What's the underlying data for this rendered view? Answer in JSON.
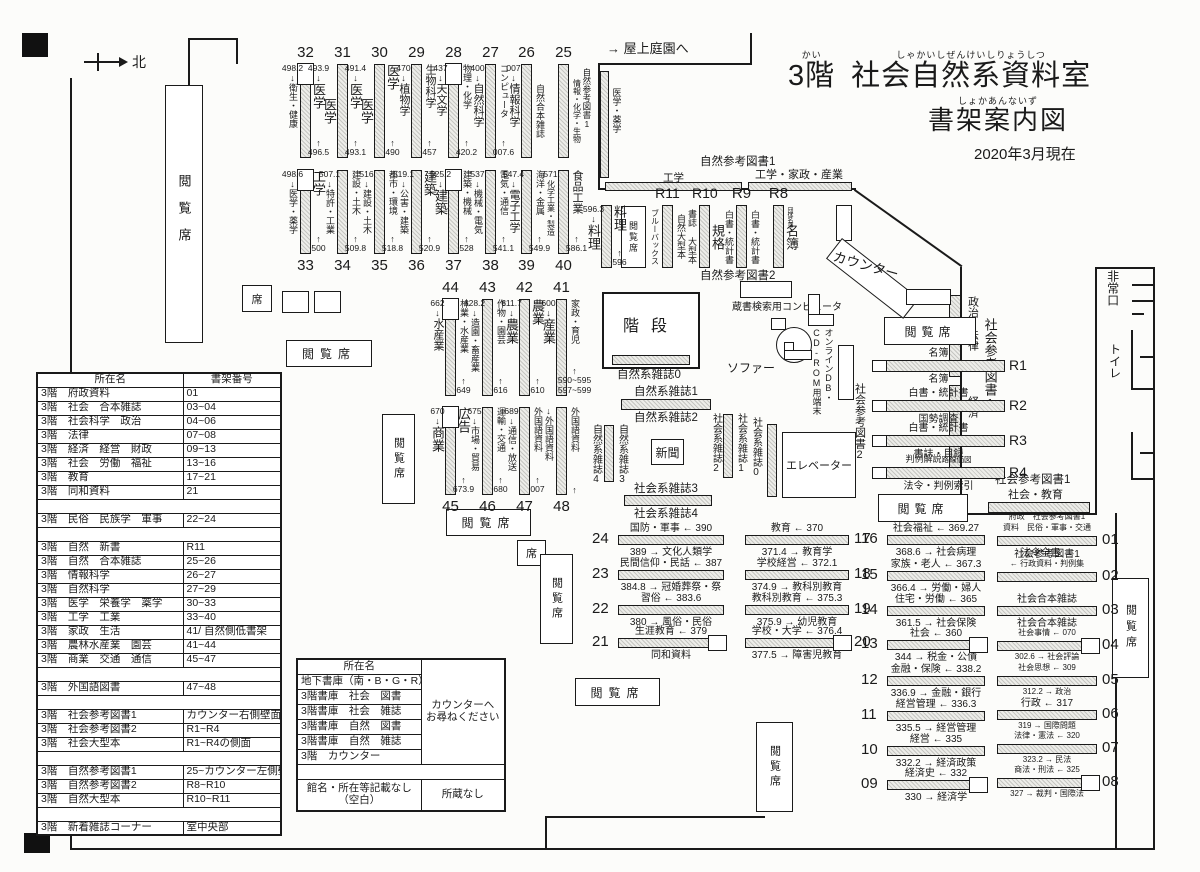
{
  "title": {
    "floor": "3階",
    "floor_ruby": "かい",
    "name": "社会自然系資料室",
    "name_ruby": "しゃかいしぜんけいしりょうしつ",
    "sub": "書架案内図",
    "sub_ruby": "しょかあんないず",
    "date": "2020年3月現在"
  },
  "misc": {
    "roof_garden": "→ 屋上庭園へ",
    "compass": "北",
    "reading_seat": "閲覧席",
    "seat": "席",
    "stairs": "階段",
    "newspaper": "新聞",
    "sofa": "ソファー",
    "elevator": "エレベーター",
    "counter": "カウンター",
    "opac": "蔵書検索用コンピュータ",
    "online1": "オンラインDB・",
    "online2": "CD-ROM用端末",
    "emergency_exit": "非常口",
    "toilet": "トイレ"
  },
  "wall": {
    "nat_ref1_v": "自然参考図書1",
    "med_pharm": "医学・薬学",
    "nat_ref1_h": "自然参考図書1",
    "eng": "工学",
    "eng_home_ind": "工学・家政・産業",
    "nat_ref2": "自然参考図書2",
    "politics_law": "政治・法律",
    "economy": "経済",
    "soc_ref1_big": "社会参考図書1",
    "soc_ref1": "社会参考図書1",
    "soc_edu": "社会・教育"
  },
  "mag": {
    "n0": "自然系雑誌0",
    "n1": "自然系雑誌1",
    "n2": "自然系雑誌2",
    "n3": "自然系雑誌3",
    "n4": "自然系雑誌4",
    "s0": "社会系雑誌0",
    "s1": "社会系雑誌1",
    "s2": "社会系雑誌2",
    "s3": "社会系雑誌3",
    "s4": "社会系雑誌4"
  },
  "shelf_rows": {
    "row1": {
      "units": [
        {
          "num": "32",
          "panel": true,
          "left": {
            "n1": "498.2",
            "a1": "↓",
            "name": "衛生・健康"
          },
          "right": {
            "n1": "493.9",
            "a1": "↓",
            "name": "医学",
            "a2": "↑",
            "n2": "496.5"
          }
        },
        {
          "num": "31",
          "left": {
            "name": "医学"
          },
          "right": {
            "n1": "491.4",
            "a1": "↓",
            "name": "医学",
            "a2": "↑",
            "n2": "493.1"
          }
        },
        {
          "num": "30",
          "left": {
            "name": "医学"
          },
          "right": {
            "name": "医学",
            "a2": "↑",
            "n2": "490"
          }
        },
        {
          "num": "29",
          "left": {
            "n1": "470",
            "a1": "↓",
            "name": "植物学"
          },
          "right": {
            "name": "生物科学",
            "a2": "↑",
            "n2": "457"
          }
        },
        {
          "num": "28",
          "panel": true,
          "left": {
            "n1": "437",
            "a1": "↓",
            "name": "天文学"
          },
          "right": {
            "name": "物理・化学",
            "a2": "↑",
            "n2": "420.2"
          }
        },
        {
          "num": "27",
          "left": {
            "n1": "400",
            "a1": "↓",
            "name": "自然科学"
          },
          "right": {
            "name": "コンピュータ",
            "a2": "↑",
            "n2": "007.6"
          }
        },
        {
          "num": "26",
          "left": {
            "n1": "007",
            "a1": "↓",
            "name": "情報科学"
          },
          "right": {
            "name": "自然合本雑誌"
          }
        },
        {
          "num": "25",
          "right": {
            "name": "情報・化学・生物"
          }
        }
      ]
    },
    "row2": {
      "units": [
        {
          "num": "33",
          "panel": true,
          "left": {
            "n1": "498.6",
            "a1": "↓",
            "name": "医学・薬学"
          },
          "right": {
            "name": "工学",
            "a2": "↑",
            "n2": "500"
          }
        },
        {
          "num": "34",
          "left": {
            "n1": "507.1",
            "a1": "↓",
            "name": "特許・工業"
          },
          "right": {
            "name": "建設・土木",
            "a2": "↑",
            "n2": "509.8"
          }
        },
        {
          "num": "35",
          "left": {
            "n1": "516",
            "a1": "↓",
            "name": "建設・土木"
          },
          "right": {
            "name": "都市・環境",
            "a2": "↑",
            "n2": "518.8"
          }
        },
        {
          "num": "36",
          "left": {
            "n1": "519.1",
            "a1": "↓",
            "name": "公害・建築"
          },
          "right": {
            "name": "建築",
            "a2": "↑",
            "n2": "520.9"
          }
        },
        {
          "num": "37",
          "panel": true,
          "left": {
            "n1": "525.2",
            "a1": "↓",
            "name": "建築"
          },
          "right": {
            "name": "建築・機械",
            "a2": "↑",
            "n2": "528"
          }
        },
        {
          "num": "38",
          "left": {
            "n1": "537",
            "a1": "↓",
            "name": "機械・電気"
          },
          "right": {
            "name": "電気・通信",
            "a2": "↑",
            "n2": "541.1"
          }
        },
        {
          "num": "39",
          "left": {
            "n1": "547.4",
            "a1": "↓",
            "name": "電子工学"
          },
          "right": {
            "name": "海洋・金属",
            "a2": "↑",
            "n2": "549.9"
          }
        },
        {
          "num": "40",
          "left": {
            "n1": "571",
            "name": "化学工業・製造"
          },
          "right": {
            "name": "食品工業",
            "a2": "↑",
            "n2": "586.1"
          }
        }
      ]
    },
    "ryori": {
      "units": [
        {
          "left": {
            "n1": "596.3",
            "a1": "↓",
            "name": "料理"
          },
          "right": {
            "name": "料理",
            "a2": "↑",
            "n2": "596"
          }
        }
      ]
    },
    "rrow": {
      "units": [
        {
          "num": "R11",
          "left": {
            "name": "ブルーバックス"
          },
          "right": {
            "name": "自然大型本"
          }
        },
        {
          "num": "R10",
          "left": {
            "name": "書誌 大型本"
          },
          "right": {
            "name": "規格"
          }
        },
        {
          "num": "R9",
          "left": {
            "name": "白書・統計書"
          },
          "right": {
            "name": "白書・統計書"
          }
        },
        {
          "num": "R8",
          "top_note": "団体名簿",
          "right": {
            "name": "名簿"
          }
        }
      ]
    },
    "row3": {
      "units": [
        {
          "num": "44",
          "panel": true,
          "left": {
            "n1": "662",
            "a1": "↓",
            "name": "水産業"
          },
          "right": {
            "name": "林業・水産業",
            "a2": "↑",
            "n2": "649"
          }
        },
        {
          "num": "43",
          "left": {
            "n1": "628.2",
            "a1": "↓",
            "name": "造園・畜産業"
          },
          "right": {
            "name": "作物・園芸",
            "a2": "↑",
            "n2": "616"
          }
        },
        {
          "num": "42",
          "left": {
            "n1": "611.7",
            "a1": "↓",
            "name": "農業"
          },
          "right": {
            "name": "農業",
            "a2": "↑",
            "n2": "610"
          }
        },
        {
          "num": "41",
          "left": {
            "n1": "600",
            "a1": "↓",
            "name": "産業"
          },
          "right": {
            "name": "家政・育児",
            "a2": "↑",
            "n2": "590~595",
            "n3": "597~599"
          }
        }
      ]
    },
    "row4": {
      "units": [
        {
          "num": "45",
          "panel": true,
          "left": {
            "n1": "670",
            "a1": "↓",
            "name": "商業"
          },
          "right": {
            "name": "広告",
            "a2": "↑",
            "n2": "673.9"
          }
        },
        {
          "num": "46",
          "left": {
            "n1": "675",
            "a1": "↓",
            "name": "市場・貿易"
          },
          "right": {
            "name": "運輸・交通",
            "a2": "↑",
            "n2": "680"
          }
        },
        {
          "num": "47",
          "left": {
            "n1": "689",
            "a1": "↓",
            "name": "通信・放送"
          },
          "right": {
            "name": "外国語資料",
            "a2": "↑",
            "n2": "007"
          }
        },
        {
          "num": "48",
          "left": {
            "a1": "↓",
            "name": "外国語資料"
          },
          "right": {
            "name": "外国語資料",
            "a2": "↑"
          }
        }
      ]
    }
  },
  "r_shelves": {
    "label": "社会参考図書2",
    "items": [
      {
        "num": "R1",
        "above": "名簿",
        "below": "名簿"
      },
      {
        "num": "R2",
        "above": "白書・統計書",
        "below": "国勢調査"
      },
      {
        "num": "R3",
        "above": "白書・統計書",
        "below": "書誌・目録"
      },
      {
        "num": "R4",
        "above": "判例解説",
        "above2": "路線価図",
        "below": "法令・判例索引"
      }
    ]
  },
  "lists": {
    "A": [
      {
        "num": "24",
        "above": "国防・軍事 ← 390",
        "below": "389 → 文化人類学"
      },
      {
        "num": "23",
        "above": "民間信仰・民話 ← 387",
        "below": "384.8 → 冠婚葬祭・祭"
      },
      {
        "num": "22",
        "above": "習俗 ← 383.6",
        "below": "380 → 風俗・民俗"
      },
      {
        "num": "21",
        "above": "生涯教育 ← 379",
        "below": "同和資料",
        "end_box": true
      }
    ],
    "B": [
      {
        "num": "17",
        "above": "教育 ← 370",
        "below": "371.4 → 教育学"
      },
      {
        "num": "18",
        "above": "学校経営 ← 372.1",
        "below": "374.9 → 教科別教育"
      },
      {
        "num": "19",
        "above": "教科別教育 ← 375.3",
        "below": "375.9 → 幼児教育"
      },
      {
        "num": "20",
        "above": "学校・大学 ← 376.4",
        "below": "377.5 → 障害児教育",
        "end_box": true
      }
    ],
    "C": [
      {
        "num": "16",
        "above": "社会福祉 ← 369.27",
        "below": "368.6 → 社会病理"
      },
      {
        "num": "15",
        "above": "家族・老人 ← 367.3",
        "below": "366.4 → 労働・婦人"
      },
      {
        "num": "14",
        "above": "住宅・労働 ← 365",
        "below": "361.5 → 社会保険"
      },
      {
        "num": "13",
        "above": "社会 ← 360",
        "below": "344 → 税金・公債",
        "end_box": true
      },
      {
        "num": "12",
        "above": "金融・保険 ← 338.2",
        "below": "336.9 → 金融・銀行"
      },
      {
        "num": "11",
        "above": "経営管理 ← 336.3",
        "below": "335.5 → 経営管理"
      },
      {
        "num": "10",
        "above": "経営 ← 335",
        "below": "332.2 → 経済政策"
      },
      {
        "num": "09",
        "above": "経済史 ← 332",
        "below": "330 → 経済学",
        "end_box": true
      }
    ],
    "D": [
      {
        "num": "01",
        "above": [
          "府政　社会参考図書1",
          "資料　民俗・軍事・交通"
        ],
        "below": [
          "法令全書 →"
        ]
      },
      {
        "num": "02",
        "above": [
          "社会参考図書1",
          "← 行政資料・判例集"
        ],
        "below": []
      },
      {
        "num": "03",
        "above": [
          "社会合本雑誌"
        ],
        "below": [
          "社会合本雑誌"
        ]
      },
      {
        "num": "04",
        "above": [
          "社会事情 ← 070"
        ],
        "below": [
          "302.6 → 社会評論"
        ],
        "end_box": true
      },
      {
        "num": "05",
        "above": [
          "社会思想 ← 309"
        ],
        "below": [
          "312.2 → 政治"
        ]
      },
      {
        "num": "06",
        "above": [
          "行政 ← 317"
        ],
        "below": [
          "319 → 国際問題"
        ]
      },
      {
        "num": "07",
        "above": [
          "法律・憲法 ← 320"
        ],
        "below": [
          "323.2 → 民法"
        ]
      },
      {
        "num": "08",
        "above": [
          "商法・刑法 ← 325"
        ],
        "below": [
          "327 → 裁判・国際法"
        ],
        "end_box": true
      }
    ]
  },
  "table1": {
    "headers": [
      "所在名",
      "書架番号"
    ],
    "rows": [
      [
        "3階　府政資料",
        "01"
      ],
      [
        "3階　社会　合本雑誌",
        "03~04"
      ],
      [
        "3階　社会科学　政治",
        "04~06"
      ],
      [
        "3階　法律",
        "07~08"
      ],
      [
        "3階　経済　経営　財政",
        "09~13"
      ],
      [
        "3階　社会　労働　福祉",
        "13~16"
      ],
      [
        "3階　教育",
        "17~21"
      ],
      [
        "3階　同和資料",
        "21"
      ],
      [
        "3階　民俗　民族学　軍事",
        "22~24"
      ],
      [
        "3階　自然　新書",
        "R11"
      ],
      [
        "3階　自然　合本雑誌",
        "25~26"
      ],
      [
        "3階　情報科学",
        "26~27"
      ],
      [
        "3階　自然科学",
        "27~29"
      ],
      [
        "3階　医学　栄養学　薬学",
        "30~33"
      ],
      [
        "3階　工学　工業",
        "33~40"
      ],
      [
        "3階　家政　生活",
        "41/ 自然側低書架"
      ],
      [
        "3階　農林水産業　園芸",
        "41~44"
      ],
      [
        "3階　商業　交通　通信",
        "45~47"
      ],
      [
        "3階　外国語図書",
        "47~48"
      ],
      [
        "3階　社会参考図書1",
        "カウンター右側壁面~02"
      ],
      [
        "3階　社会参考図書2",
        "R1~R4"
      ],
      [
        "3階　社会大型本",
        "R1~R4の側面"
      ],
      [
        "3階　自然参考図書1",
        "25~カウンター左側壁面"
      ],
      [
        "3階　自然参考図書2",
        "R8~R10"
      ],
      [
        "3階　自然大型本",
        "R10~R11"
      ],
      [
        "3階　新着雑誌コーナー",
        "室中央部"
      ]
    ],
    "gaps": [
      7,
      8,
      17,
      18,
      21,
      24
    ]
  },
  "table2": {
    "header": "所在名",
    "rows": [
      "地下書庫（南・B・G・R）",
      "3階書庫　社会　図書",
      "3階書庫　社会　雑誌",
      "3階書庫　自然　図書",
      "3階書庫　自然　雑誌",
      "3階　カウンター"
    ],
    "note1": "カウンターへ",
    "note2": "お尋ねください",
    "foot_left1": "館名・所在等記載なし",
    "foot_left2": "（空白）",
    "foot_right": "所蔵なし"
  }
}
